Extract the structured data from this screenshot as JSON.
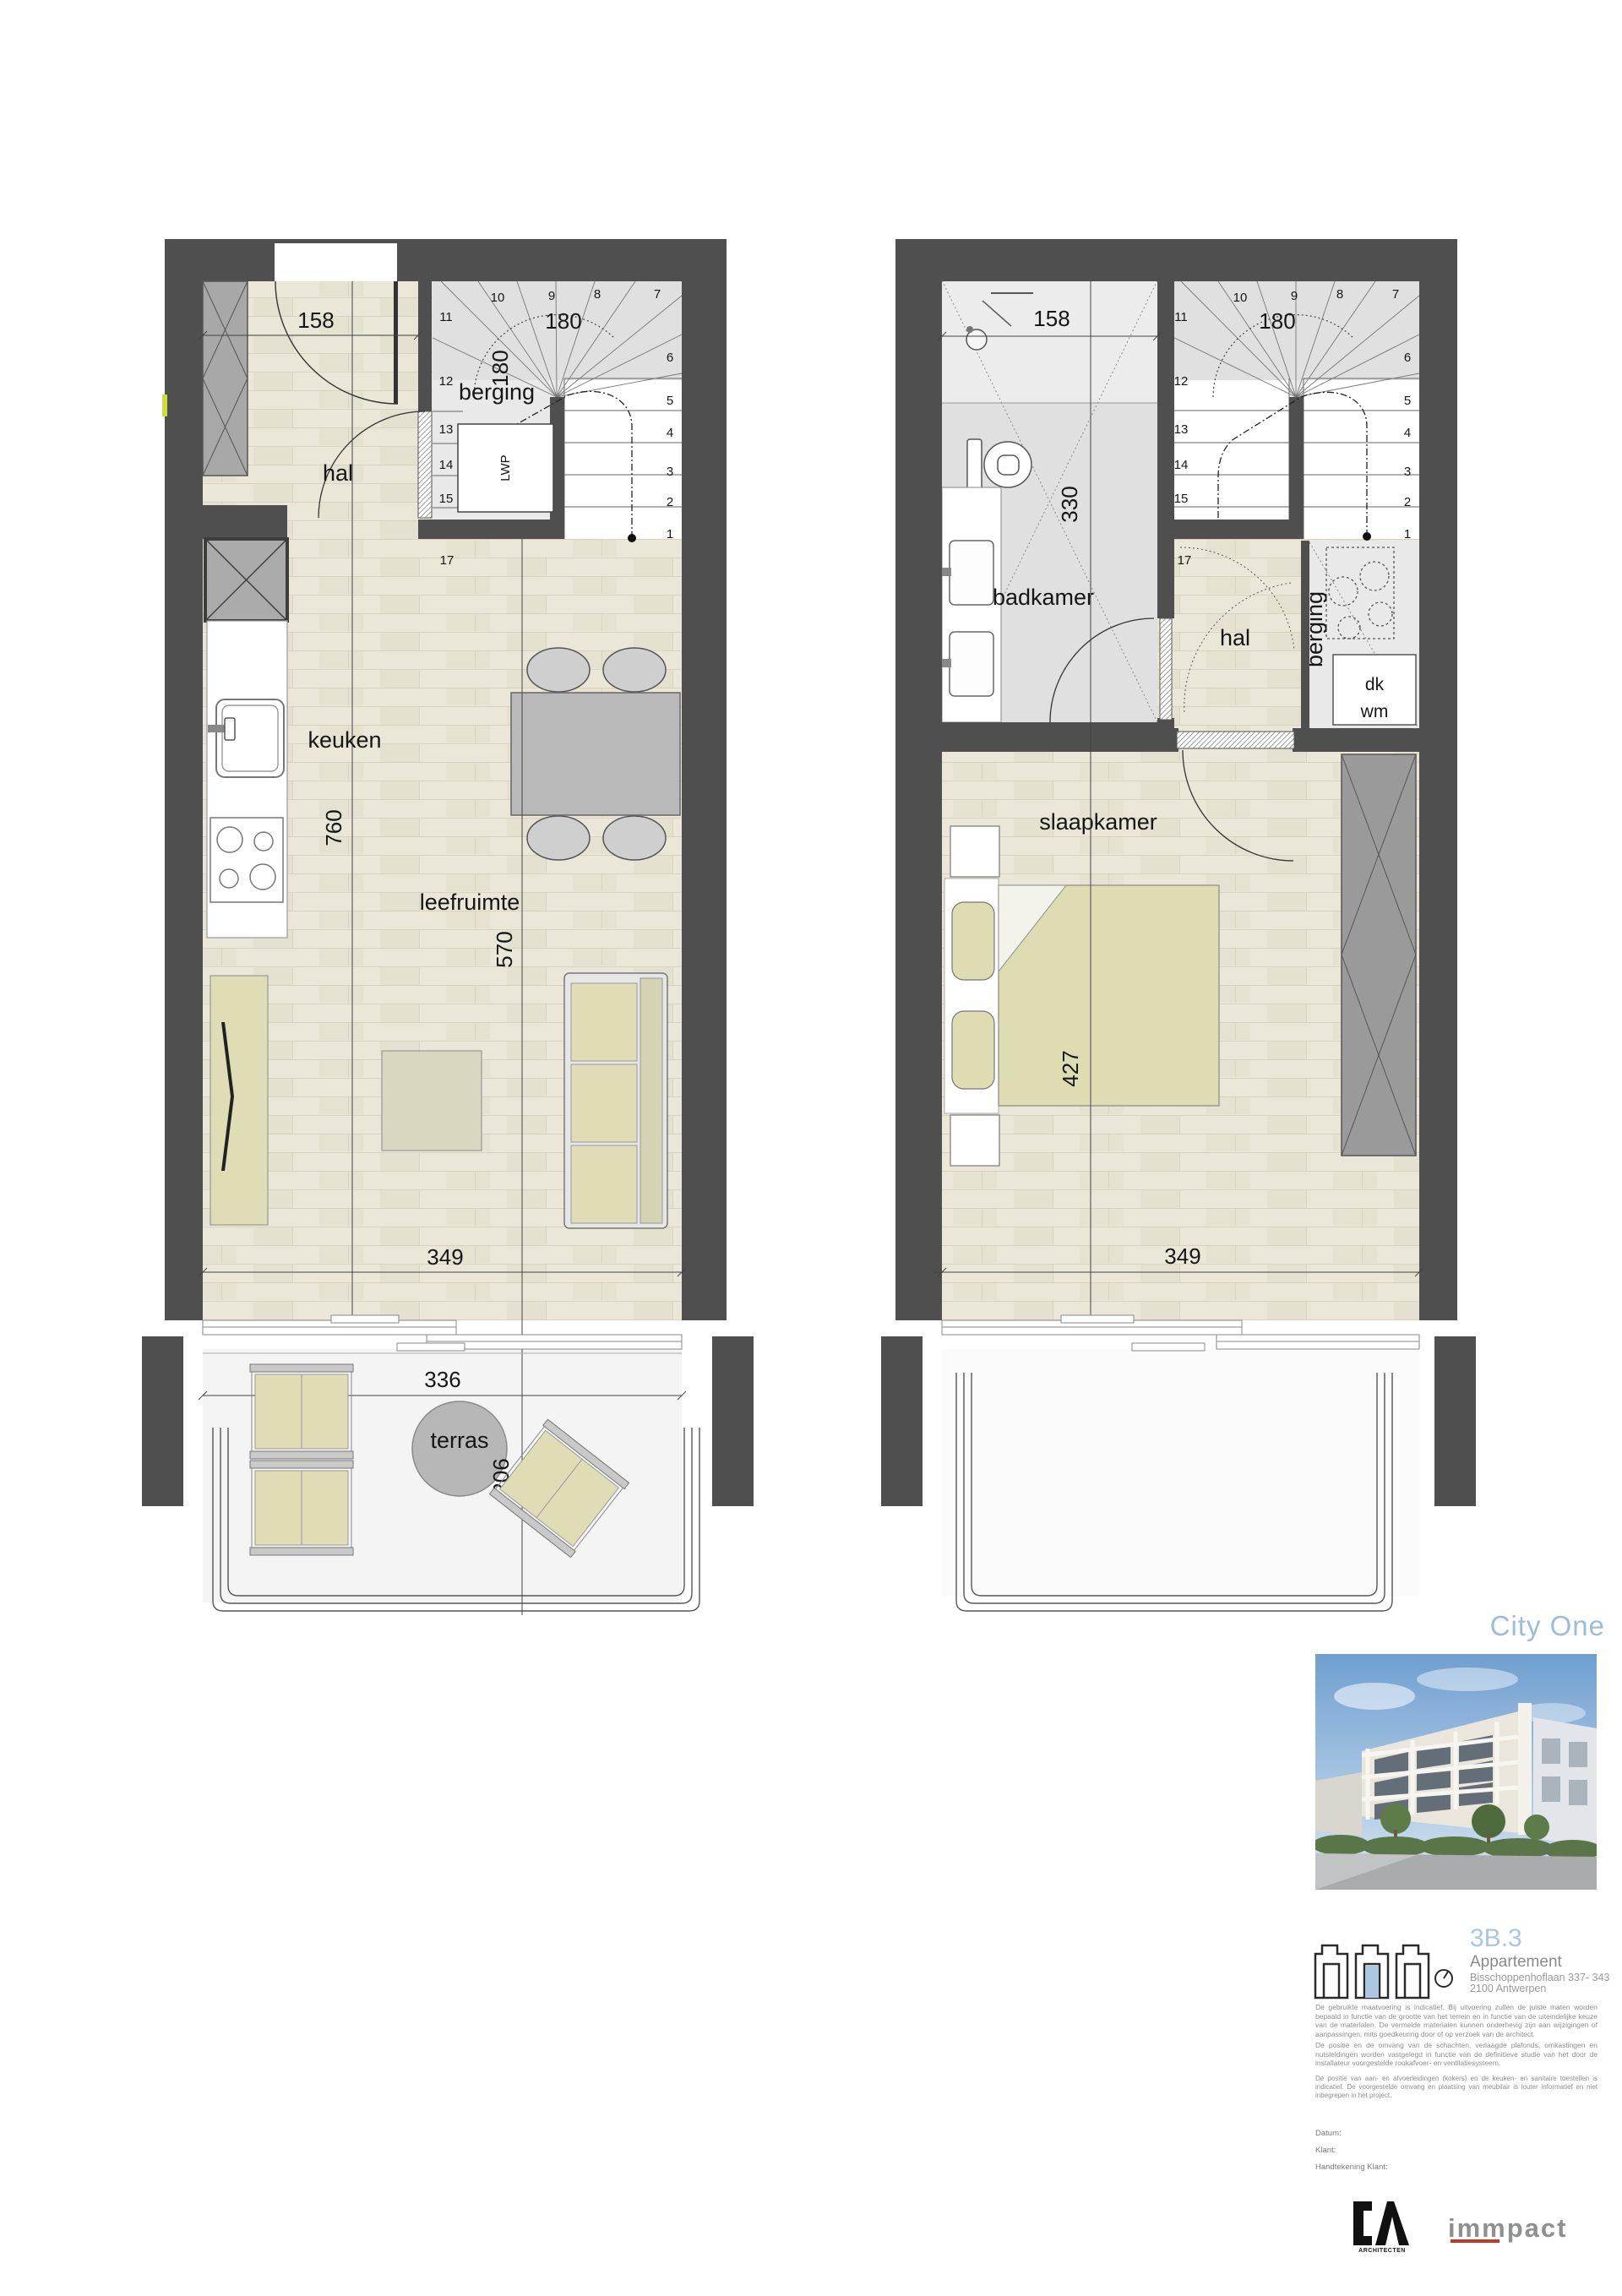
{
  "colors": {
    "wall": "#4f4f4f",
    "accent_blue": "#a9c6e2",
    "logo_red": "#c0392b"
  },
  "plans": {
    "left": {
      "rooms": {
        "hal": "hal",
        "berging": "berging",
        "keuken": "keuken",
        "leefruimte": "leefruimte",
        "terras": "terras"
      },
      "fixtures": {
        "heat_pump": "LWP"
      },
      "dims": {
        "entry_width": "158",
        "stair_width": "180",
        "stair_depth": "180",
        "kitchen_length": "760",
        "living_length": "570",
        "living_width": "349",
        "terrace_width": "336",
        "terrace_depth": "206"
      },
      "stairs": [
        "1",
        "2",
        "3",
        "4",
        "5",
        "6",
        "7",
        "8",
        "9",
        "10",
        "11",
        "12",
        "13",
        "14",
        "15",
        "16",
        "17"
      ]
    },
    "right": {
      "rooms": {
        "badkamer": "badkamer",
        "hal": "hal",
        "berging": "berging",
        "slaapkamer": "slaapkamer"
      },
      "fixtures": {
        "dryer": "dk",
        "washer": "wm"
      },
      "dims": {
        "bath_width": "158",
        "stair_width": "180",
        "bath_length": "330",
        "bedroom_length": "427",
        "bedroom_width": "349"
      },
      "stairs": [
        "1",
        "2",
        "3",
        "4",
        "5",
        "6",
        "7",
        "8",
        "9",
        "10",
        "11",
        "12",
        "13",
        "14",
        "15",
        "16",
        "17"
      ]
    }
  },
  "titleblock": {
    "project": "City One",
    "unit": "3B.3",
    "type": "Appartement",
    "address_line1": "Bisschoppenhoflaan 337- 343",
    "address_line2": "2100 Antwerpen",
    "disclaimer1": "De gebruikte maatvoering is indicatief. Bij uitvoering zullen de juiste maten worden bepaald in functie van de grootte van het terrein en in functie van de uiteindelijke keuze van de materialen. De vermelde materialen kunnen onderhevig zijn aan wijzigingen of aanpassingen, mits goedkeuring door of op verzoek van de architect.",
    "disclaimer2": "De positie en de omvang van de schachten, verlaagde plafonds, omkastingen en nutsleidingen worden vastgelegd in functie van de definitieve studie van het door de installateur voorgestelde rookafvoer- en ventilatiesysteem.",
    "disclaimer3": "De positie van aan- en afvoerleidingen (kokers) en de keuken- en sanitaire toestellen is indicatief. De voorgestelde omvang en plaatsing van meubilair is louter informatief en niet inbegrepen in het project.",
    "field_date": "Datum:",
    "field_client": "Klant:",
    "field_signature": "Handtekening Klant:",
    "architect_logo_text": "ARCHITECTEN",
    "developer_logo_text": "immpact"
  }
}
